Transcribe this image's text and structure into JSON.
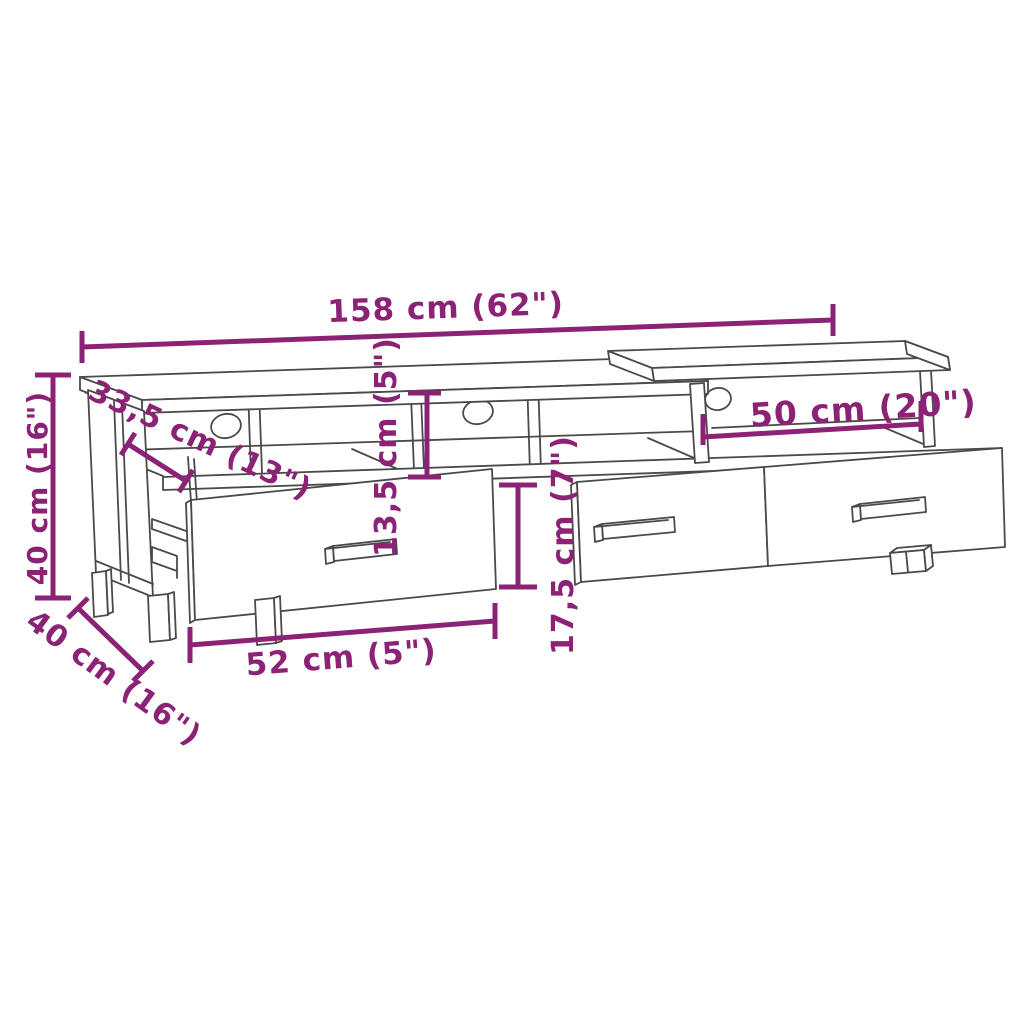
{
  "diagram": {
    "type": "furniture-dimension-line-drawing",
    "subject": "TV stand with three open compartments, cable holes and three drawers",
    "style": {
      "dimension_color": "#8C2276",
      "outline_color": "#4A4A4A",
      "background": "#FFFFFF"
    },
    "dimensions": {
      "total_width": "158 cm (62\")",
      "total_height": "40 cm (16\")",
      "total_depth": "40 cm (16\")",
      "top_depth": "33,5 cm (13\")",
      "shelf_opening_height": "13,5 cm (5\")",
      "right_opening_width": "50 cm (20\")",
      "drawer_front_height": "17,5 cm (7\")",
      "drawer_width": "52 cm (5\")"
    }
  }
}
